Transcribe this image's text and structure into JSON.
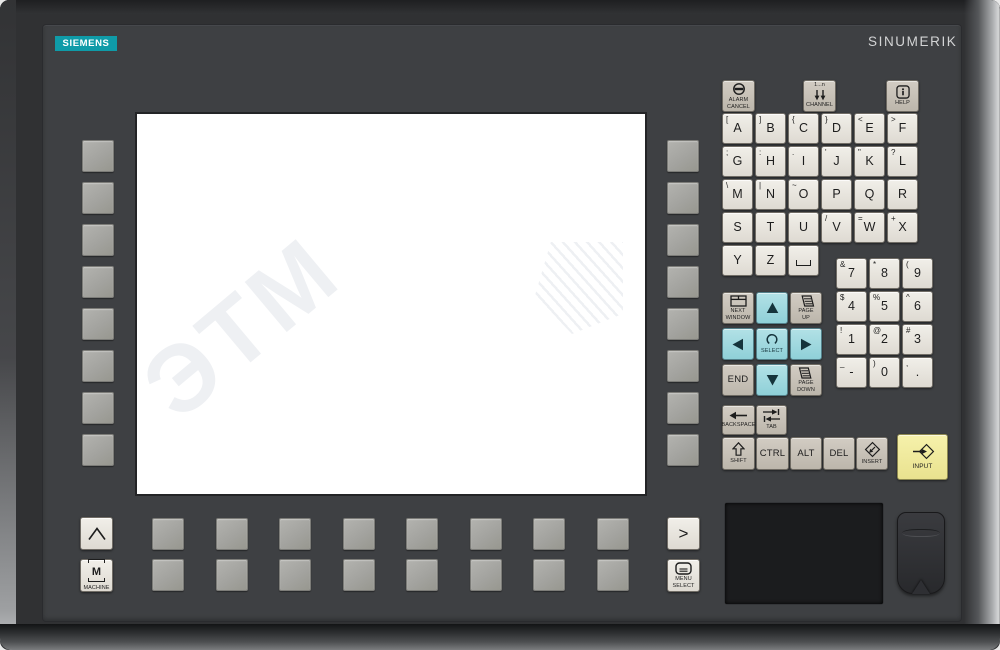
{
  "brand": {
    "logo_text": "SIEMENS",
    "product_text": "SINUMERIK",
    "logo_bg_color": "#0f9ba8",
    "logo_text_color": "#ffffff",
    "product_text_color": "#d3d4d5"
  },
  "screen": {
    "watermark_text": "ЭТМ",
    "background_color": "#ffffff"
  },
  "colors": {
    "panel": "#3e4043",
    "key_light": "#ece9e3",
    "key_gray": "#c9c3b9",
    "key_cyan": "#a4dbe1",
    "key_yellow": "#f2eda0",
    "softkey": "#a7a7a3",
    "touchpad": "#1b1c1e"
  },
  "keyboard": {
    "system_keys": [
      {
        "id": "alarm-cancel",
        "icon": "alarm-cancel-icon",
        "label": "ALARM\nCANCEL"
      },
      {
        "id": "channel",
        "icon": "channel-icon",
        "top_text": "1...n",
        "label": "CHANNEL"
      },
      {
        "id": "help",
        "icon": "help-icon",
        "label": "HELP"
      }
    ],
    "alpha_rows": [
      [
        {
          "label": "A",
          "shift": "["
        },
        {
          "label": "B",
          "shift": "]"
        },
        {
          "label": "C",
          "shift": "{"
        },
        {
          "label": "D",
          "shift": "}"
        },
        {
          "label": "E",
          "shift": "<"
        },
        {
          "label": "F",
          "shift": ">"
        }
      ],
      [
        {
          "label": "G",
          "shift": ";"
        },
        {
          "label": "H",
          "shift": ":"
        },
        {
          "label": "I",
          "shift": "."
        },
        {
          "label": "J",
          "shift": "'"
        },
        {
          "label": "K",
          "shift": "\""
        },
        {
          "label": "L",
          "shift": "?"
        }
      ],
      [
        {
          "label": "M",
          "shift": "\\"
        },
        {
          "label": "N",
          "shift": "|"
        },
        {
          "label": "O",
          "shift": "~"
        },
        {
          "label": "P",
          "shift": ""
        },
        {
          "label": "Q",
          "shift": ""
        },
        {
          "label": "R",
          "shift": ""
        }
      ],
      [
        {
          "label": "S",
          "shift": ""
        },
        {
          "label": "T",
          "shift": ""
        },
        {
          "label": "U",
          "shift": ""
        },
        {
          "label": "V",
          "shift": "/"
        },
        {
          "label": "W",
          "shift": "="
        },
        {
          "label": "X",
          "shift": "+"
        }
      ],
      [
        {
          "label": "Y",
          "shift": ""
        },
        {
          "label": "Z",
          "shift": ""
        },
        {
          "label": "",
          "shift": "",
          "space": true
        }
      ]
    ],
    "numpad_rows": [
      [
        {
          "label": "7",
          "shift": "&"
        },
        {
          "label": "8",
          "shift": "*"
        },
        {
          "label": "9",
          "shift": "("
        }
      ],
      [
        {
          "label": "4",
          "shift": "$"
        },
        {
          "label": "5",
          "shift": "%"
        },
        {
          "label": "6",
          "shift": "^"
        }
      ],
      [
        {
          "label": "1",
          "shift": "!"
        },
        {
          "label": "2",
          "shift": "@"
        },
        {
          "label": "3",
          "shift": "#"
        }
      ],
      [
        {
          "label": "-",
          "shift": "_"
        },
        {
          "label": "0",
          "shift": ")"
        },
        {
          "label": ".",
          "shift": ","
        }
      ]
    ],
    "cursor_keys": [
      {
        "id": "next-window",
        "type": "gray",
        "icon": "next-window-icon",
        "label": "NEXT\nWINDOW"
      },
      {
        "id": "cursor-up",
        "type": "cyan",
        "icon": "arrow-up-icon"
      },
      {
        "id": "page-up",
        "type": "gray",
        "icon": "page-up-icon",
        "label": "PAGE\nUP"
      },
      {
        "id": "cursor-left",
        "type": "cyan",
        "icon": "arrow-left-icon"
      },
      {
        "id": "select",
        "type": "cyan",
        "icon": "select-icon",
        "label": "SELECT"
      },
      {
        "id": "cursor-right",
        "type": "cyan",
        "icon": "arrow-right-icon"
      },
      {
        "id": "end",
        "type": "gray",
        "text": "END"
      },
      {
        "id": "cursor-down",
        "type": "cyan",
        "icon": "arrow-down-icon"
      },
      {
        "id": "page-down",
        "type": "gray",
        "icon": "page-down-icon",
        "label": "PAGE\nDOWN"
      }
    ],
    "edit_keys": [
      {
        "id": "backspace",
        "icon": "backspace-icon",
        "label": "BACKSPACE"
      },
      {
        "id": "tab",
        "icon": "tab-icon",
        "label": "TAB"
      }
    ],
    "modifier_keys": [
      {
        "id": "shift",
        "icon": "shift-icon",
        "label": "SHIFT"
      },
      {
        "id": "ctrl",
        "text": "CTRL"
      },
      {
        "id": "alt",
        "text": "ALT"
      },
      {
        "id": "del",
        "text": "DEL"
      },
      {
        "id": "insert",
        "icon": "insert-icon",
        "label": "INSERT"
      }
    ],
    "input_key": {
      "id": "input",
      "icon": "input-icon",
      "label": "INPUT"
    }
  },
  "hotkeys": {
    "recall": {
      "id": "recall",
      "icon": "caret-icon"
    },
    "machine": {
      "id": "machine",
      "letter": "M",
      "label": "MACHINE"
    },
    "menu_forward": {
      "id": "menu-forward",
      "text": ">"
    },
    "menu_select": {
      "id": "menu-select",
      "icon": "menu-select-icon",
      "label": "MENU\nSELECT"
    }
  },
  "softkeys": {
    "left": 8,
    "right": 8,
    "bottom_top_row": 8,
    "bottom_lower_row": 8
  }
}
